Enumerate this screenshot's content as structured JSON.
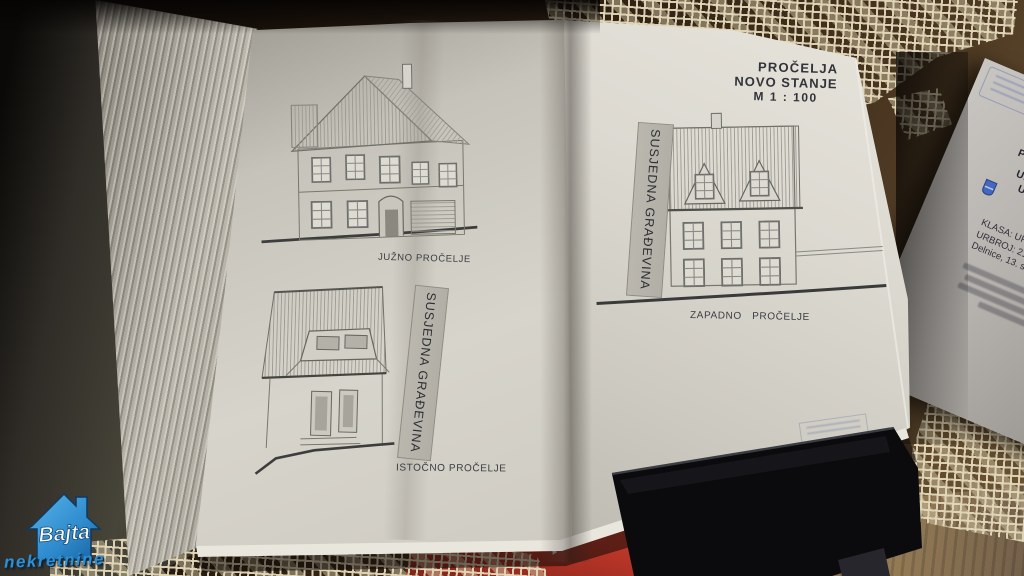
{
  "sheet": {
    "title_block": {
      "line1": "PROČELJA",
      "line2": "NOVO STANJE",
      "line3": "M 1 : 100"
    },
    "south_label": "JUŽNO PROČELJE",
    "east_label": "ISTOČNO PROČELJE",
    "west_label": "ZAPADNO PROČELJE",
    "banner_left": "SUSJEDNA GRAĐEVINA",
    "banner_right": "SUSJEDNA GRAĐEVINA"
  },
  "official_paper": {
    "header": [
      "REPUBLIKA HRVATSKA",
      "PRIMORSKO-GORANSKA ŽUPANIJA",
      "UPRAVNI ODJEL ZA PROSTORNO",
      "UREĐENJE, GRADITELJSTVO I",
      "ZAŠTITU OKOLIŠA",
      "ISPOSTAVA DELNICE"
    ],
    "meta": [
      "KLASA: UP/I-361-03/18-06/44",
      "URBROJ: 2170/1-03/2-18",
      "Delnice, 13. studenoga 2018."
    ]
  },
  "watermark": {
    "brand": "Bajta",
    "tagline": "nekretnine"
  },
  "magazine": {
    "letters": "AK"
  },
  "colors": {
    "page": "#d8d5cd",
    "ink": "#3b3b42",
    "bajta_blue": "#2f8fd2",
    "magazine_red": "#b23326",
    "doily_cream": "#e2d7b8",
    "table_brown": "#46331f"
  }
}
